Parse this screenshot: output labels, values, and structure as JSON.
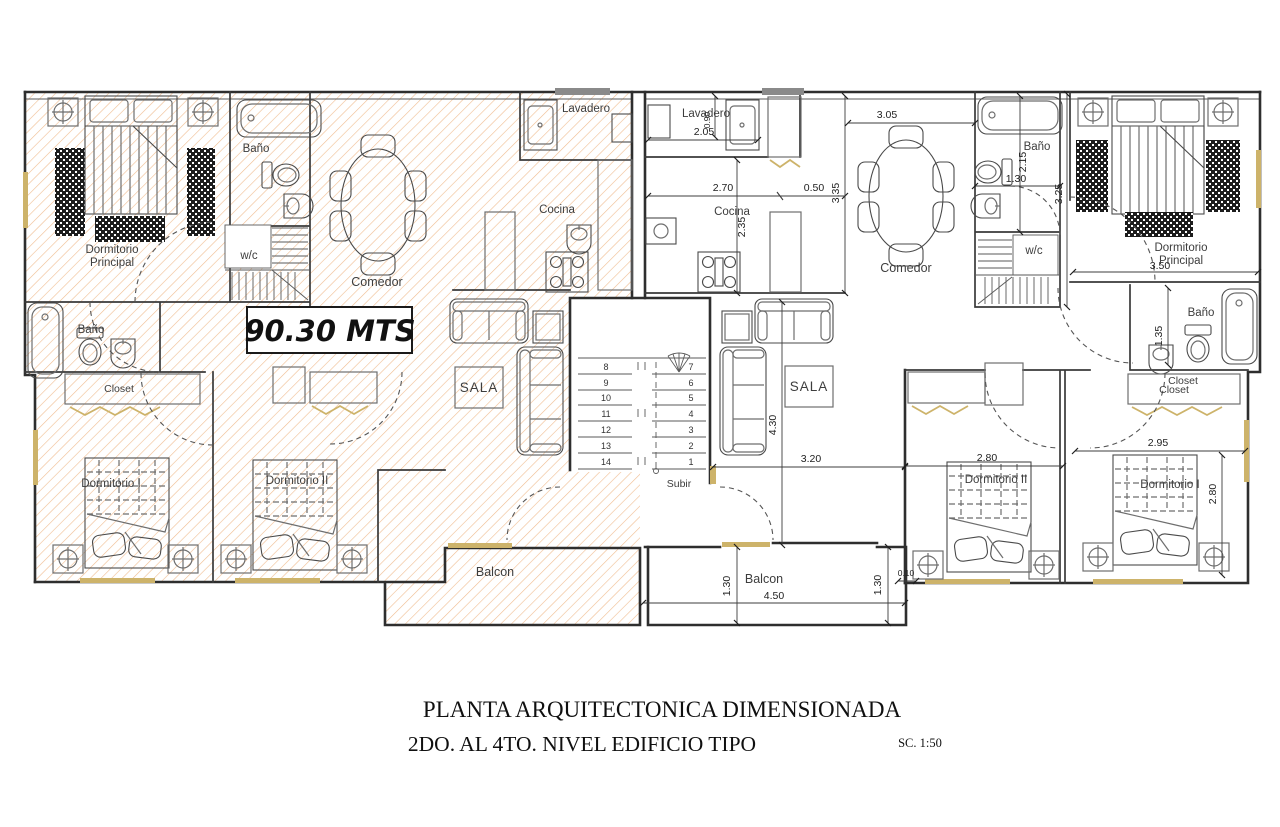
{
  "colors": {
    "hatch": "#EBA76C",
    "wall": "#2e2e2e",
    "furniture": "#6e6e6e",
    "accent_tan": "#CDB36A",
    "text": "#3d3d3d",
    "paper": "#ffffff"
  },
  "badge": {
    "area": "90.30 MTS"
  },
  "left_unit": {
    "dorm_principal_1": "Dormitorio",
    "dorm_principal_2": "Principal",
    "bano_top": "Baño",
    "wc": "w/c",
    "comedor": "Comedor",
    "lavadero": "Lavadero",
    "cocina": "Cocina",
    "bano_mid": "Baño",
    "closet": "Closet",
    "sala": "SALA",
    "dormitorio_1": "Dormitorio I",
    "dormitorio_2": "Dormitorio II",
    "balcon": "Balcon"
  },
  "right_unit": {
    "lavadero": "Lavadero",
    "cocina": "Cocina",
    "comedor": "Comedor",
    "bano_top": "Baño",
    "wc": "w/c",
    "dorm_principal_1": "Dormitorio",
    "dorm_principal_2": "Principal",
    "bano_low": "Baño",
    "closet_a": "Closet",
    "closet_b": "Closet",
    "sala": "SALA",
    "dormitorio_2": "Dormitorio II",
    "dormitorio_1": "Dormitorio I",
    "balcon": "Balcon"
  },
  "dims": {
    "lavadero_w": "2.05",
    "lavadero_h": "0.90",
    "cocina_w": "2.70",
    "pass_w": "0.50",
    "cocina_out_h": "3.35",
    "cocina_in_h": "2.35",
    "comedor_w": "3.05",
    "bano_h": "2.15",
    "bano_w": "1.30",
    "hall_h": "3.25",
    "dormp_w": "3.50",
    "bano2_h": "1.35",
    "sala_h": "4.30",
    "sala_w": "3.20",
    "dorm2_w": "2.80",
    "dorm1_w": "2.95",
    "dorm1_h": "2.80",
    "balcon_h_left": "1.30",
    "balcon_w": "4.50",
    "balcon_h_right": "1.30",
    "wall_t": "0.10"
  },
  "stairs": {
    "subir": "Subir",
    "left": [
      "8",
      "9",
      "10",
      "11",
      "12",
      "13",
      "14"
    ],
    "right": [
      "7",
      "6",
      "5",
      "4",
      "3",
      "2",
      "1"
    ]
  },
  "title": {
    "line1": "PLANTA ARQUITECTONICA DIMENSIONADA",
    "line2": "2DO. AL 4TO. NIVEL EDIFICIO  TIPO",
    "scale": "SC. 1:50"
  }
}
